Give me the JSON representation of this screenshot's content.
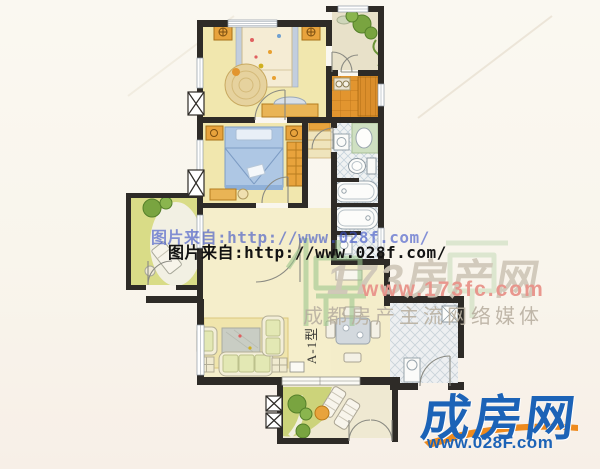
{
  "watermarks": {
    "photo_credit_shadow": "图片来自:http://www.028f.com/",
    "photo_credit": "图片来自:http://www.028f.com/",
    "portal_name": "173房产网",
    "portal_url": "www.173fc.com",
    "portal_tagline": "成都房产主流网络媒体"
  },
  "logo": {
    "name": "成房网",
    "url": "www.028F.com"
  },
  "floorplan": {
    "unit_label": "A-1型"
  },
  "colors": {
    "wall": "#2e2b27",
    "bedroom_floor": "#f1e7ae",
    "hall_floor": "#f5eecb",
    "balcony_green": "#d9dc87",
    "kitchen_orange": "#e2952f",
    "bath_floor": "#f0f2f2",
    "furniture_orange": "#e8a33c",
    "bed_blue": "#aec7e4",
    "logo_blue": "#1c63b7",
    "logo_swoosh_orange": "#ee8a1d",
    "watermark_red": "#e9938a",
    "watermark_gray": "#cfc7b8",
    "watermark_blue": "#3d53c9"
  }
}
